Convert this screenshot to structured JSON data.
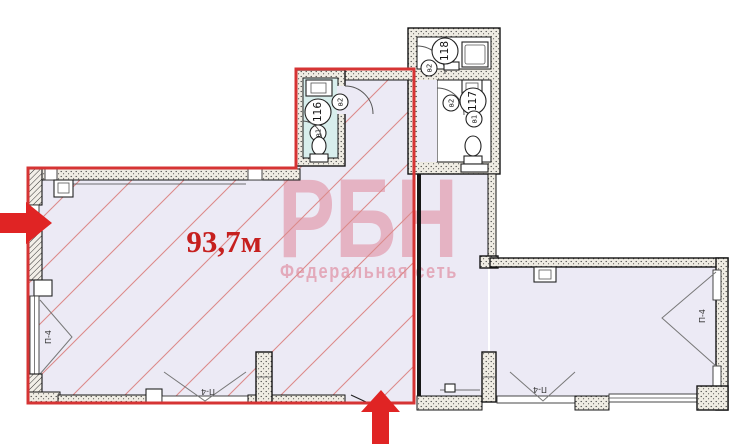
{
  "plan": {
    "area_label": "93,7м",
    "unit_rooms": {
      "bath": "116"
    },
    "neighbor_rooms": {
      "bath_upper": "118",
      "bath_lower": "117"
    },
    "fixture_labels": {
      "basin1": "в1",
      "basin2": "в2"
    },
    "window_label": "П-4",
    "watermark": {
      "brand": "РБН",
      "subtitle": "Федеральная сеть"
    },
    "colors": {
      "highlight_outline": "#d63434",
      "hatch_line": "#dc8a8a",
      "floor_fill": "#eceaf5",
      "bathroom_fill": "#d8eeec",
      "arrow": "#e02424",
      "watermark_pink": "#d9536d",
      "area_text": "#c6201f"
    }
  }
}
